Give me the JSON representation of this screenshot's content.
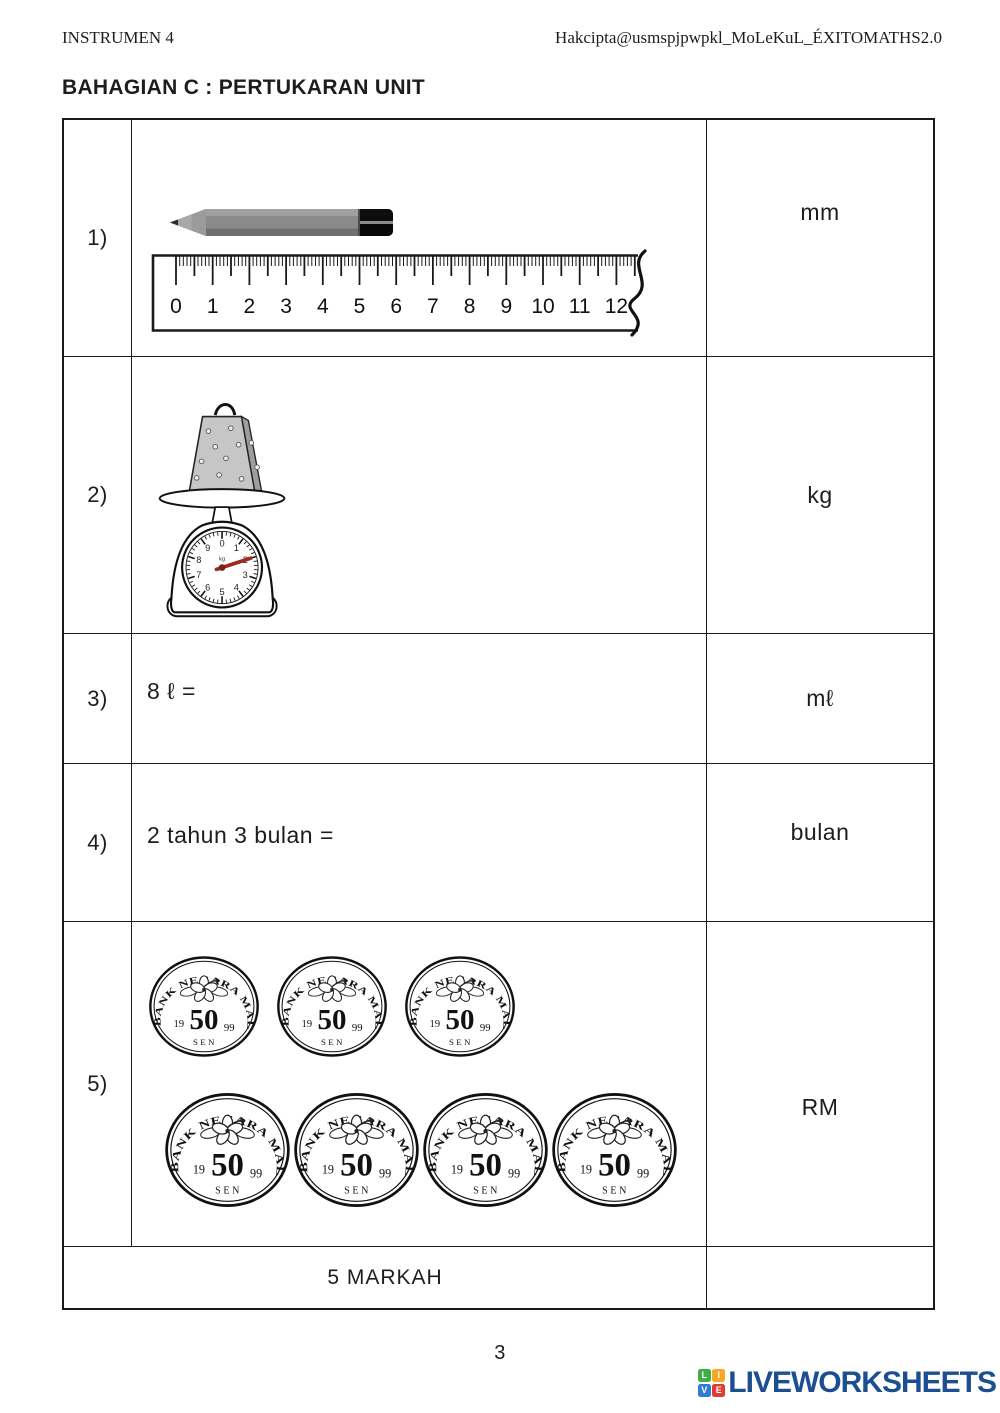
{
  "page": {
    "header_left": "INSTRUMEN 4",
    "header_right": "Hakcipta@usmspjpwpkl_MoLeKuL_ÉXITOMATHS2.0",
    "section_title": "BAHAGIAN C : PERTUKARAN UNIT",
    "page_number": "3"
  },
  "table": {
    "rows": [
      {
        "num": "1)",
        "question": ""
      },
      {
        "num": "2)",
        "question": ""
      },
      {
        "num": "3)",
        "question": "8 ℓ ="
      },
      {
        "num": "4)",
        "question": "2 tahun 3 bulan ="
      },
      {
        "num": "5)",
        "question": ""
      }
    ],
    "marks_label": "5 MARKAH"
  },
  "answers": [
    {
      "prefix": "",
      "unit": "mm"
    },
    {
      "prefix": "",
      "unit": "kg"
    },
    {
      "prefix": "",
      "unit": "mℓ"
    },
    {
      "prefix": "",
      "unit": "bulan"
    },
    {
      "prefix": "RM",
      "unit": ""
    }
  ],
  "ruler": {
    "numbers": [
      0,
      1,
      2,
      3,
      4,
      5,
      6,
      7,
      8,
      9,
      10,
      11,
      12
    ]
  },
  "pencil": {
    "body_color": "#8a8a8a",
    "cap_color": "#0d0d0d"
  },
  "scale": {
    "dial_numbers": [
      0,
      1,
      2,
      3,
      4,
      5,
      6,
      7,
      8,
      9
    ],
    "dial_unit": "kg",
    "needle_value": 2,
    "needle_color": "#9c2a20",
    "bag_color": "#c6c6c6"
  },
  "coins": {
    "bank_text": "BANK NEGARA MALAYSIA",
    "year_left": "19",
    "value": "50",
    "year_right": "99",
    "unit": "SEN",
    "layout_rows": [
      3,
      4
    ]
  },
  "logo": {
    "text": "LIVEWORKSHEETS",
    "text_color": "#1c4f92",
    "squares": [
      {
        "letter": "L",
        "color": "#3fae49"
      },
      {
        "letter": "I",
        "color": "#f9a825"
      },
      {
        "letter": "V",
        "color": "#2e7cd6"
      },
      {
        "letter": "E",
        "color": "#e23b34"
      }
    ]
  }
}
